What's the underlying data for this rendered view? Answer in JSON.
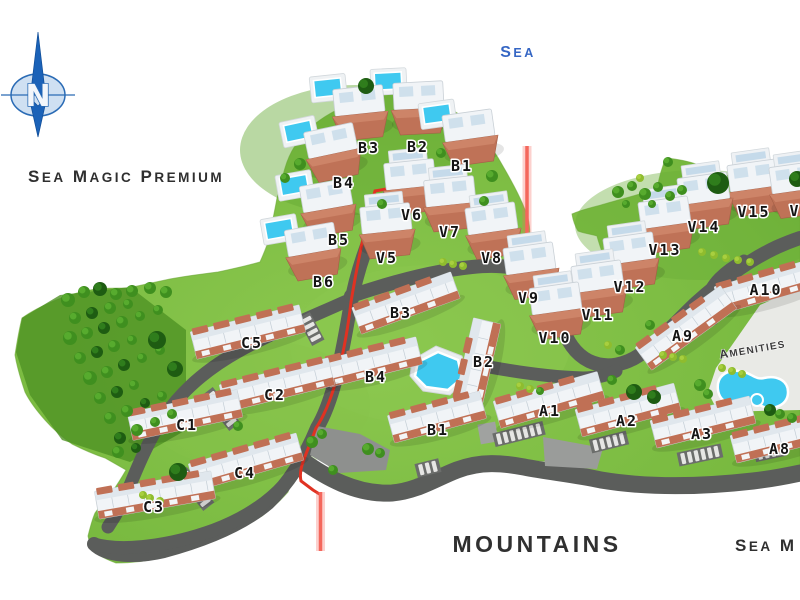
{
  "title": "Sea Magic Premium",
  "compass": {
    "label": "N"
  },
  "area_labels": {
    "sea": "Sea",
    "mountains": "MOUNTAINS",
    "amenities": "Amenities",
    "bottom_right_partial": "Sea M"
  },
  "colors": {
    "background": "#ffffff",
    "grass": "#79ba40",
    "grass_dark": "#4f9224",
    "road": "#5b5d5b",
    "roof_terracotta": "#c07055",
    "building_white": "#f1f4f7",
    "pool_water": "#3fc9f0",
    "red_boundary_line": "#e03222",
    "red_marker_line": "#f4675c",
    "sea_text_blue": "#3566c4",
    "label_text": "#141414",
    "compass_blue": "#1b62b8"
  },
  "buildings": [
    {
      "id": "b3-villa",
      "label": "B3",
      "type": "villa-pool",
      "x": 360,
      "y": 112,
      "rot": -6,
      "lx": 369,
      "ly": 153
    },
    {
      "id": "b2-villa",
      "label": "B2",
      "type": "villa-pool",
      "x": 419,
      "y": 107,
      "rot": -3,
      "lx": 418,
      "ly": 152
    },
    {
      "id": "b1-villa",
      "label": "B1",
      "type": "villa-pool",
      "x": 470,
      "y": 137,
      "rot": -8,
      "lx": 462,
      "ly": 171
    },
    {
      "id": "b4-villa",
      "label": "B4",
      "type": "villa-pool",
      "x": 333,
      "y": 152,
      "rot": -12,
      "lx": 344,
      "ly": 188
    },
    {
      "id": "b5-villa",
      "label": "B5",
      "type": "villa-pool",
      "x": 328,
      "y": 207,
      "rot": -10,
      "lx": 339,
      "ly": 245
    },
    {
      "id": "b6-villa",
      "label": "B6",
      "type": "villa-pool",
      "x": 313,
      "y": 251,
      "rot": -10,
      "lx": 324,
      "ly": 287
    },
    {
      "id": "v6",
      "label": "V6",
      "type": "villa",
      "x": 411,
      "y": 186,
      "rot": -6,
      "lx": 412,
      "ly": 220
    },
    {
      "id": "v7",
      "label": "V7",
      "type": "villa",
      "x": 451,
      "y": 203,
      "rot": -6,
      "lx": 450,
      "ly": 237
    },
    {
      "id": "v5",
      "label": "V5",
      "type": "villa",
      "x": 387,
      "y": 230,
      "rot": -6,
      "lx": 387,
      "ly": 263
    },
    {
      "id": "v8",
      "label": "V8",
      "type": "villa",
      "x": 493,
      "y": 230,
      "rot": -8,
      "lx": 492,
      "ly": 263
    },
    {
      "id": "v9",
      "label": "V9",
      "type": "villa",
      "x": 531,
      "y": 270,
      "rot": -8,
      "lx": 529,
      "ly": 303
    },
    {
      "id": "v10",
      "label": "V10",
      "type": "villa",
      "x": 557,
      "y": 310,
      "rot": -8,
      "lx": 555,
      "ly": 343
    },
    {
      "id": "v11",
      "label": "V11",
      "type": "villa",
      "x": 599,
      "y": 288,
      "rot": -8,
      "lx": 598,
      "ly": 320
    },
    {
      "id": "v12",
      "label": "V12",
      "type": "villa",
      "x": 631,
      "y": 260,
      "rot": -8,
      "lx": 630,
      "ly": 292
    },
    {
      "id": "v13",
      "label": "V13",
      "type": "villa",
      "x": 666,
      "y": 224,
      "rot": -8,
      "lx": 665,
      "ly": 255
    },
    {
      "id": "v14",
      "label": "V14",
      "type": "villa",
      "x": 705,
      "y": 200,
      "rot": -8,
      "lx": 704,
      "ly": 232
    },
    {
      "id": "v15",
      "label": "V15",
      "type": "villa",
      "x": 755,
      "y": 187,
      "rot": -8,
      "lx": 754,
      "ly": 217
    },
    {
      "id": "v16-partial",
      "label": "V",
      "type": "villa",
      "x": 797,
      "y": 189,
      "rot": -8,
      "lx": 795,
      "ly": 216
    },
    {
      "id": "b3-block",
      "label": "B3",
      "type": "apartment",
      "x": 406,
      "y": 303,
      "rot": -20,
      "len": 105,
      "lx": 401,
      "ly": 318
    },
    {
      "id": "b2-block",
      "label": "B2",
      "type": "apartment",
      "x": 478,
      "y": 361,
      "rot": -77,
      "len": 82,
      "lx": 484,
      "ly": 367
    },
    {
      "id": "b4-block",
      "label": "B4",
      "type": "apartment",
      "x": 373,
      "y": 362,
      "rot": -14,
      "len": 95,
      "lx": 376,
      "ly": 382
    },
    {
      "id": "b1-block",
      "label": "B1",
      "type": "apartment",
      "x": 437,
      "y": 417,
      "rot": -15,
      "len": 95,
      "lx": 438,
      "ly": 435
    },
    {
      "id": "c5",
      "label": "C5",
      "type": "apartment",
      "x": 248,
      "y": 332,
      "rot": -14,
      "len": 112,
      "lx": 252,
      "ly": 348
    },
    {
      "id": "c2",
      "label": "C2",
      "type": "apartment",
      "x": 277,
      "y": 385,
      "rot": -14,
      "len": 112,
      "lx": 275,
      "ly": 400
    },
    {
      "id": "c1",
      "label": "C1",
      "type": "apartment",
      "x": 185,
      "y": 415,
      "rot": -12,
      "len": 112,
      "lx": 187,
      "ly": 430
    },
    {
      "id": "c4",
      "label": "C4",
      "type": "apartment",
      "x": 246,
      "y": 462,
      "rot": -16,
      "len": 112,
      "lx": 245,
      "ly": 478
    },
    {
      "id": "c3",
      "label": "C3",
      "type": "apartment",
      "x": 155,
      "y": 495,
      "rot": -10,
      "len": 118,
      "lx": 154,
      "ly": 512
    },
    {
      "id": "a1",
      "label": "A1",
      "type": "apartment",
      "x": 549,
      "y": 400,
      "rot": -16,
      "len": 108,
      "lx": 550,
      "ly": 416
    },
    {
      "id": "a2",
      "label": "A2",
      "type": "apartment",
      "x": 628,
      "y": 410,
      "rot": -15,
      "len": 102,
      "lx": 627,
      "ly": 426
    },
    {
      "id": "a3",
      "label": "A3",
      "type": "apartment",
      "x": 703,
      "y": 422,
      "rot": -14,
      "len": 102,
      "lx": 702,
      "ly": 439
    },
    {
      "id": "a8",
      "label": "A8",
      "type": "apartment",
      "x": 783,
      "y": 437,
      "rot": -14,
      "len": 102,
      "lx": 780,
      "ly": 454
    },
    {
      "id": "a9",
      "label": "A9",
      "type": "apartment",
      "x": 686,
      "y": 328,
      "rot": -36,
      "len": 105,
      "lx": 683,
      "ly": 341
    },
    {
      "id": "a10",
      "label": "A10",
      "type": "apartment",
      "x": 768,
      "y": 286,
      "rot": -16,
      "len": 104,
      "lx": 766,
      "ly": 295
    }
  ]
}
